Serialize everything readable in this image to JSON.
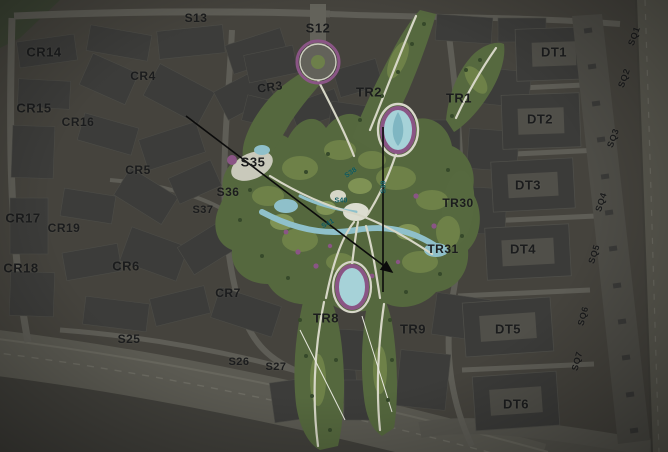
{
  "map": {
    "description": "aerial-masterplan-with-zone-labels",
    "colors": {
      "ground": "#45433d",
      "building": "#3c3c3a",
      "road": "#5e5d56",
      "park_green": "#55683e",
      "park_light_green": "#6e8148",
      "path_cream": "#d6d6c6",
      "water_teal": "#8fc0ca",
      "accent_purple": "#8a5585",
      "label_dark": "#1b1c1d",
      "label_teal": "#0c5a60",
      "survey_line": "#0b0b0b"
    },
    "labels": [
      {
        "text": "S13",
        "x": 196,
        "y": 18,
        "type": "dark",
        "size": 12,
        "rot": 0
      },
      {
        "text": "S12",
        "x": 318,
        "y": 28,
        "type": "dark",
        "size": 13,
        "rot": 0
      },
      {
        "text": "CR14",
        "x": 44,
        "y": 52,
        "type": "dark",
        "size": 13,
        "rot": 0
      },
      {
        "text": "CR4",
        "x": 143,
        "y": 76,
        "type": "dark",
        "size": 12,
        "rot": 0
      },
      {
        "text": "CR3",
        "x": 270,
        "y": 87,
        "type": "dark",
        "size": 12,
        "rot": -8
      },
      {
        "text": "TR2",
        "x": 369,
        "y": 92,
        "type": "dark",
        "size": 13,
        "rot": 0
      },
      {
        "text": "TR1",
        "x": 459,
        "y": 98,
        "type": "dark",
        "size": 13,
        "rot": 0
      },
      {
        "text": "DT1",
        "x": 554,
        "y": 52,
        "type": "dark",
        "size": 13,
        "rot": 0
      },
      {
        "text": "DT2",
        "x": 540,
        "y": 119,
        "type": "dark",
        "size": 13,
        "rot": 0
      },
      {
        "text": "CR15",
        "x": 34,
        "y": 108,
        "type": "dark",
        "size": 13,
        "rot": 0
      },
      {
        "text": "CR16",
        "x": 78,
        "y": 122,
        "type": "dark",
        "size": 12,
        "rot": 0
      },
      {
        "text": "CR5",
        "x": 138,
        "y": 170,
        "type": "dark",
        "size": 12,
        "rot": 0
      },
      {
        "text": "S35",
        "x": 253,
        "y": 162,
        "type": "dark",
        "size": 13,
        "rot": 0
      },
      {
        "text": "S36",
        "x": 228,
        "y": 192,
        "type": "dark",
        "size": 12,
        "rot": 0
      },
      {
        "text": "S37",
        "x": 203,
        "y": 210,
        "type": "dark",
        "size": 11,
        "rot": 0
      },
      {
        "text": "CR17",
        "x": 23,
        "y": 218,
        "type": "dark",
        "size": 13,
        "rot": 0
      },
      {
        "text": "CR19",
        "x": 64,
        "y": 228,
        "type": "dark",
        "size": 12,
        "rot": 0
      },
      {
        "text": "DT3",
        "x": 528,
        "y": 185,
        "type": "dark",
        "size": 13,
        "rot": 0
      },
      {
        "text": "TR30",
        "x": 458,
        "y": 203,
        "type": "dark",
        "size": 12,
        "rot": 0
      },
      {
        "text": "TR31",
        "x": 443,
        "y": 249,
        "type": "dark",
        "size": 12,
        "rot": 0
      },
      {
        "text": "DT4",
        "x": 523,
        "y": 249,
        "type": "dark",
        "size": 13,
        "rot": 0
      },
      {
        "text": "CR18",
        "x": 21,
        "y": 268,
        "type": "dark",
        "size": 13,
        "rot": 0
      },
      {
        "text": "CR6",
        "x": 126,
        "y": 266,
        "type": "dark",
        "size": 13,
        "rot": 0
      },
      {
        "text": "CR7",
        "x": 228,
        "y": 293,
        "type": "dark",
        "size": 12,
        "rot": 0
      },
      {
        "text": "TR8",
        "x": 326,
        "y": 318,
        "type": "dark",
        "size": 13,
        "rot": 0
      },
      {
        "text": "TR9",
        "x": 413,
        "y": 329,
        "type": "dark",
        "size": 13,
        "rot": 0
      },
      {
        "text": "DT5",
        "x": 508,
        "y": 329,
        "type": "dark",
        "size": 13,
        "rot": 0
      },
      {
        "text": "S25",
        "x": 129,
        "y": 339,
        "type": "dark",
        "size": 12,
        "rot": 0
      },
      {
        "text": "S26",
        "x": 239,
        "y": 362,
        "type": "dark",
        "size": 11,
        "rot": 0
      },
      {
        "text": "S27",
        "x": 276,
        "y": 367,
        "type": "dark",
        "size": 11,
        "rot": 0
      },
      {
        "text": "DT6",
        "x": 516,
        "y": 404,
        "type": "dark",
        "size": 13,
        "rot": 0
      },
      {
        "text": "SQ1",
        "x": 634,
        "y": 36,
        "type": "dark",
        "size": 9,
        "rot": -70
      },
      {
        "text": "SQ2",
        "x": 624,
        "y": 78,
        "type": "dark",
        "size": 9,
        "rot": -70
      },
      {
        "text": "SQ3",
        "x": 613,
        "y": 138,
        "type": "dark",
        "size": 9,
        "rot": -70
      },
      {
        "text": "SQ4",
        "x": 601,
        "y": 202,
        "type": "dark",
        "size": 9,
        "rot": -72
      },
      {
        "text": "SQ5",
        "x": 594,
        "y": 254,
        "type": "dark",
        "size": 9,
        "rot": -72
      },
      {
        "text": "SQ6",
        "x": 583,
        "y": 316,
        "type": "dark",
        "size": 9,
        "rot": -75
      },
      {
        "text": "SQ7",
        "x": 577,
        "y": 361,
        "type": "dark",
        "size": 9,
        "rot": -75
      },
      {
        "text": "S38",
        "x": 351,
        "y": 173,
        "type": "teal",
        "size": 7,
        "rot": -35
      },
      {
        "text": "S39",
        "x": 384,
        "y": 187,
        "type": "teal",
        "size": 7,
        "rot": -90
      },
      {
        "text": "S40",
        "x": 341,
        "y": 201,
        "type": "teal",
        "size": 7,
        "rot": 0
      },
      {
        "text": "S41",
        "x": 328,
        "y": 224,
        "type": "teal",
        "size": 7,
        "rot": -28
      }
    ],
    "survey_lines": [
      {
        "x1": 186,
        "y1": 116,
        "x2": 392,
        "y2": 272,
        "arrow": true
      },
      {
        "x1": 383,
        "y1": 127,
        "x2": 383,
        "y2": 292,
        "arrow": false
      }
    ]
  }
}
